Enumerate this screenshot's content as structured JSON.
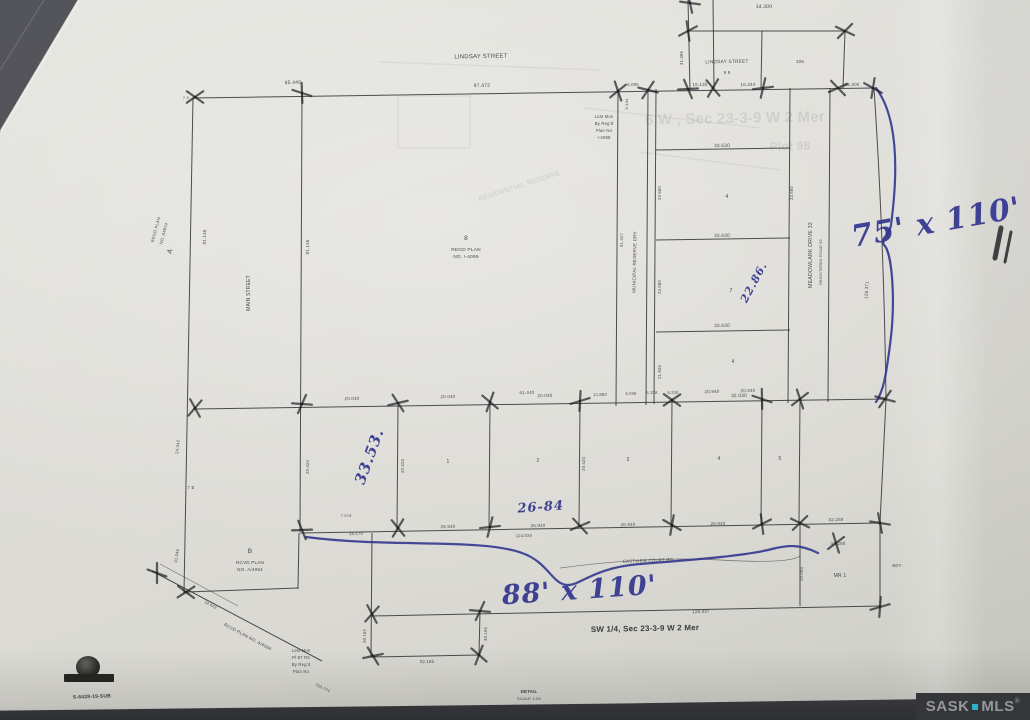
{
  "photo": {
    "paper_color": "#dddcd7",
    "background_color": "#515257",
    "ink_blue": "#32368f",
    "watermark": {
      "left": "SASK",
      "right": "MLS",
      "reg": "®",
      "dot_color": "#2fb0c6"
    }
  },
  "handwritten_annotations": {
    "right_lots": "75' x 110'",
    "bottom_lots": "88' x 110'",
    "depth_note": "33.53.",
    "width_note": "26-84",
    "lot7_note": "22.86."
  },
  "plan": {
    "title_quarter": "SW 1/4, Sec 23-3-9 W 2 Mer",
    "file_number": "S-6428-19-SUB",
    "labels": [
      {
        "t": "LINDSAY STREET",
        "x": 481,
        "y": 58,
        "r": -1,
        "s": 6,
        "n": "street-label-lindsay-west"
      },
      {
        "t": "97.472",
        "x": 482,
        "y": 87,
        "r": -1,
        "s": 5,
        "n": "dimension-label"
      },
      {
        "t": "85.440",
        "x": 293,
        "y": 84,
        "r": -2,
        "s": 5,
        "n": "dimension-label"
      },
      {
        "t": "7.9",
        "x": 186,
        "y": 99,
        "r": 0,
        "s": 4,
        "n": "dimension-label"
      },
      {
        "t": "34.300",
        "x": 764,
        "y": 8,
        "r": -1,
        "s": 5,
        "n": "dimension-label"
      },
      {
        "t": "LINDSAY STREET",
        "x": 727,
        "y": 63,
        "r": -1,
        "s": 4.8,
        "n": "street-label-lindsay-east"
      },
      {
        "t": "9 9",
        "x": 727,
        "y": 74,
        "r": 0,
        "s": 4.5,
        "n": "lot-number"
      },
      {
        "t": "105",
        "x": 800,
        "y": 63,
        "r": 0,
        "s": 4.5,
        "n": "lot-number"
      },
      {
        "t": "15.135",
        "x": 700,
        "y": 86,
        "r": -1,
        "s": 4.5,
        "n": "dimension-label"
      },
      {
        "t": "16.344",
        "x": 748,
        "y": 86,
        "r": -1,
        "s": 4.5,
        "n": "dimension-label"
      },
      {
        "t": "34.300",
        "x": 852,
        "y": 86,
        "r": -1,
        "s": 4.5,
        "n": "dimension-label"
      },
      {
        "t": "31.396",
        "x": 683,
        "y": 58,
        "r": -90,
        "s": 4.2,
        "n": "dimension-label"
      },
      {
        "t": "6.096",
        "x": 633,
        "y": 86,
        "r": -1,
        "s": 4.2,
        "n": "dimension-label"
      },
      {
        "t": "Lost Mon",
        "x": 604,
        "y": 118,
        "r": 0,
        "s": 4.2,
        "n": "monument-note"
      },
      {
        "t": "By Reg'd",
        "x": 604,
        "y": 125,
        "r": 0,
        "s": 4.2,
        "n": "monument-note"
      },
      {
        "t": "Plan No",
        "x": 604,
        "y": 132,
        "r": 0,
        "s": 4.2,
        "n": "monument-note"
      },
      {
        "t": "I-4099",
        "x": 604,
        "y": 139,
        "r": 0,
        "s": 4.2,
        "n": "monument-note"
      },
      {
        "t": "9.144",
        "x": 628,
        "y": 104,
        "r": -90,
        "s": 4,
        "n": "dimension-label"
      },
      {
        "t": "33.630",
        "x": 722,
        "y": 147,
        "r": -1,
        "s": 4.8,
        "n": "dimension-label"
      },
      {
        "t": "4",
        "x": 727,
        "y": 198,
        "r": 0,
        "s": 5,
        "n": "lot-number"
      },
      {
        "t": "33.630",
        "x": 722,
        "y": 237,
        "r": -1,
        "s": 4.8,
        "n": "dimension-label"
      },
      {
        "t": "7",
        "x": 731,
        "y": 292,
        "r": 0,
        "s": 5.5,
        "n": "lot-number"
      },
      {
        "t": "33.630",
        "x": 722,
        "y": 327,
        "r": -1,
        "s": 4.8,
        "n": "dimension-label"
      },
      {
        "t": "4",
        "x": 733,
        "y": 363,
        "r": 0,
        "s": 5,
        "n": "lot-number"
      },
      {
        "t": "32.030",
        "x": 739,
        "y": 397,
        "r": -1,
        "s": 4.8,
        "n": "dimension-label"
      },
      {
        "t": "23.680",
        "x": 661,
        "y": 193,
        "r": -90,
        "s": 4.2,
        "n": "dimension-label"
      },
      {
        "t": "23.680",
        "x": 661,
        "y": 287,
        "r": -90,
        "s": 4.2,
        "n": "dimension-label"
      },
      {
        "t": "23.680",
        "x": 793,
        "y": 193,
        "r": -90,
        "s": 4.2,
        "n": "dimension-label"
      },
      {
        "t": "21.945",
        "x": 661,
        "y": 372,
        "r": -90,
        "s": 4.2,
        "n": "dimension-label"
      },
      {
        "t": "MEADOWLARK DRIVE 32",
        "x": 812,
        "y": 255,
        "r": -90,
        "s": 5.2,
        "n": "street-label-meadowlark"
      },
      {
        "t": "REGISTERED ROAD 99",
        "x": 822,
        "y": 262,
        "r": -90,
        "s": 3.8,
        "n": "road-note"
      },
      {
        "t": "126.371",
        "x": 868,
        "y": 290,
        "r": -87,
        "s": 4.5,
        "n": "dimension-label"
      },
      {
        "t": "8",
        "x": 466,
        "y": 240,
        "r": 0,
        "s": 6.5,
        "n": "block-number"
      },
      {
        "t": "REGD PLAN",
        "x": 466,
        "y": 251,
        "r": 0,
        "s": 4.8,
        "n": "plan-note"
      },
      {
        "t": "NO. I-4099",
        "x": 466,
        "y": 258,
        "r": 0,
        "s": 4.8,
        "n": "plan-note"
      },
      {
        "t": "MAIN STREET",
        "x": 250,
        "y": 293,
        "r": -90,
        "s": 5,
        "n": "street-label-main"
      },
      {
        "t": "81.145",
        "x": 206,
        "y": 237,
        "r": -89,
        "s": 4.5,
        "n": "dimension-label"
      },
      {
        "t": "81.145",
        "x": 309,
        "y": 247,
        "r": -89,
        "s": 4.5,
        "n": "dimension-label"
      },
      {
        "t": "MUNICIPAL RESERVE DRY",
        "x": 636,
        "y": 262,
        "r": -89,
        "s": 4.5,
        "n": "reserve-label"
      },
      {
        "t": "91.427",
        "x": 623,
        "y": 240,
        "r": -89,
        "s": 4.2,
        "n": "dimension-label"
      },
      {
        "t": "A",
        "x": 172,
        "y": 252,
        "r": -70,
        "s": 7,
        "n": "parcel-label-a"
      },
      {
        "t": "REGD PLAN",
        "x": 157,
        "y": 230,
        "r": -75,
        "s": 4.2,
        "n": "plan-note"
      },
      {
        "t": "NO. A4874",
        "x": 165,
        "y": 234,
        "r": -75,
        "s": 4.2,
        "n": "plan-note"
      },
      {
        "t": "24.342",
        "x": 179,
        "y": 447,
        "r": -84,
        "s": 4.2,
        "n": "dimension-label"
      },
      {
        "t": "7 B",
        "x": 191,
        "y": 489,
        "r": 0,
        "s": 4.2,
        "n": "dimension-label"
      },
      {
        "t": "31.046",
        "x": 178,
        "y": 556,
        "r": -80,
        "s": 4.2,
        "n": "dimension-label"
      },
      {
        "t": "7.9",
        "x": 186,
        "y": 595,
        "r": 0,
        "s": 4,
        "n": "dimension-label"
      },
      {
        "t": "20.040",
        "x": 352,
        "y": 400,
        "r": -1,
        "s": 4.5,
        "n": "dimension-label"
      },
      {
        "t": "61.440",
        "x": 527,
        "y": 394,
        "r": -1,
        "s": 4.5,
        "n": "dimension-label"
      },
      {
        "t": "20.040",
        "x": 448,
        "y": 398,
        "r": -1,
        "s": 4.5,
        "n": "dimension-label"
      },
      {
        "t": "20.040",
        "x": 545,
        "y": 397,
        "r": -1,
        "s": 4.5,
        "n": "dimension-label"
      },
      {
        "t": "13.880",
        "x": 600,
        "y": 396,
        "r": -1,
        "s": 4.2,
        "n": "dimension-label"
      },
      {
        "t": "6.096",
        "x": 631,
        "y": 395,
        "r": -1,
        "s": 4,
        "n": "dimension-label"
      },
      {
        "t": "5.338",
        "x": 652,
        "y": 394,
        "r": -1,
        "s": 4,
        "n": "dimension-label"
      },
      {
        "t": "8.230",
        "x": 673,
        "y": 394,
        "r": -1,
        "s": 4,
        "n": "dimension-label"
      },
      {
        "t": "20.940",
        "x": 712,
        "y": 393,
        "r": -1,
        "s": 4.5,
        "n": "dimension-label"
      },
      {
        "t": "20.940",
        "x": 748,
        "y": 392,
        "r": -1,
        "s": 4.5,
        "n": "dimension-label"
      },
      {
        "t": "20.420",
        "x": 309,
        "y": 467,
        "r": -89,
        "s": 4.2,
        "n": "dimension-label"
      },
      {
        "t": "20.420",
        "x": 404,
        "y": 466,
        "r": -89,
        "s": 4.2,
        "n": "dimension-label"
      },
      {
        "t": "20.420",
        "x": 585,
        "y": 464,
        "r": -89,
        "s": 4.2,
        "n": "dimension-label"
      },
      {
        "t": "1",
        "x": 448,
        "y": 463,
        "r": 0,
        "s": 5,
        "n": "lot-number"
      },
      {
        "t": "2",
        "x": 538,
        "y": 462,
        "r": 0,
        "s": 5,
        "n": "lot-number"
      },
      {
        "t": "3",
        "x": 628,
        "y": 461,
        "r": 0,
        "s": 5,
        "n": "lot-number"
      },
      {
        "t": "4",
        "x": 719,
        "y": 460,
        "r": 0,
        "s": 5,
        "n": "lot-number"
      },
      {
        "t": "5",
        "x": 780,
        "y": 460,
        "r": 0,
        "s": 5,
        "n": "lot-number"
      },
      {
        "t": "7.975",
        "x": 346,
        "y": 517,
        "r": 0,
        "s": 4,
        "n": "dimension-label"
      },
      {
        "t": "14.170",
        "x": 356,
        "y": 535,
        "r": -1,
        "s": 4.2,
        "n": "dimension-label"
      },
      {
        "t": "26.940",
        "x": 448,
        "y": 528,
        "r": -1,
        "s": 4.5,
        "n": "dimension-label"
      },
      {
        "t": "26.940",
        "x": 538,
        "y": 527,
        "r": -1,
        "s": 4.5,
        "n": "dimension-label"
      },
      {
        "t": "114.035",
        "x": 524,
        "y": 537,
        "r": -1,
        "s": 4.2,
        "n": "dimension-label"
      },
      {
        "t": "26.940",
        "x": 628,
        "y": 526,
        "r": -1,
        "s": 4.5,
        "n": "dimension-label"
      },
      {
        "t": "26.940",
        "x": 718,
        "y": 525,
        "r": -1,
        "s": 4.5,
        "n": "dimension-label"
      },
      {
        "t": "32.288",
        "x": 836,
        "y": 521,
        "r": -1,
        "s": 4.5,
        "n": "dimension-label"
      },
      {
        "t": "32.288",
        "x": 838,
        "y": 545,
        "r": -1,
        "s": 4.5,
        "n": "dimension-label"
      },
      {
        "t": "20.068",
        "x": 803,
        "y": 574,
        "r": -89,
        "s": 4.2,
        "n": "dimension-label"
      },
      {
        "t": "MR 1",
        "x": 840,
        "y": 577,
        "r": 0,
        "s": 5,
        "n": "reserve-lot-label"
      },
      {
        "t": "BDY",
        "x": 897,
        "y": 567,
        "r": 0,
        "s": 4.2,
        "n": "boundary-note"
      },
      {
        "t": "EASTVIEW COURT RD",
        "x": 648,
        "y": 562,
        "r": -2,
        "s": 4.4,
        "n": "street-label-court"
      },
      {
        "t": "B",
        "x": 250,
        "y": 553,
        "r": 0,
        "s": 6.5,
        "n": "parcel-label-b"
      },
      {
        "t": "RCVD PLAN",
        "x": 250,
        "y": 564,
        "r": 0,
        "s": 4.6,
        "n": "plan-note"
      },
      {
        "t": "NO. A/4084",
        "x": 250,
        "y": 571,
        "r": 0,
        "s": 4.6,
        "n": "plan-note"
      },
      {
        "t": "RCVD PLAN NO. A/4084",
        "x": 247,
        "y": 638,
        "r": 28,
        "s": 4.4,
        "n": "road-plan-note"
      },
      {
        "t": "34.842",
        "x": 210,
        "y": 606,
        "r": 28,
        "s": 4,
        "n": "dimension-label"
      },
      {
        "t": "730.774",
        "x": 322,
        "y": 689,
        "r": 26,
        "s": 4,
        "n": "dimension-label"
      },
      {
        "t": "Lost Mon",
        "x": 301,
        "y": 652,
        "r": 0,
        "s": 4.2,
        "n": "monument-note"
      },
      {
        "t": "Pl 97 R2",
        "x": 301,
        "y": 659,
        "r": 0,
        "s": 4.2,
        "n": "monument-note"
      },
      {
        "t": "By Reg'd",
        "x": 301,
        "y": 666,
        "r": 0,
        "s": 4.2,
        "n": "monument-note"
      },
      {
        "t": "Plan No",
        "x": 301,
        "y": 673,
        "r": 0,
        "s": 4.2,
        "n": "monument-note"
      },
      {
        "t": "30.165",
        "x": 366,
        "y": 636,
        "r": -89,
        "s": 4.2,
        "n": "dimension-label"
      },
      {
        "t": "30.165",
        "x": 487,
        "y": 634,
        "r": -89,
        "s": 4.2,
        "n": "dimension-label"
      },
      {
        "t": "32.185",
        "x": 427,
        "y": 663,
        "r": -1,
        "s": 4.4,
        "n": "dimension-label"
      },
      {
        "t": "SW 1/4, Sec 23-3-9 W 2 Mer",
        "x": 645,
        "y": 631,
        "r": -1,
        "s": 8,
        "k": "bold",
        "n": "quarter-section-title"
      },
      {
        "t": "128.037",
        "x": 701,
        "y": 613,
        "r": -1,
        "s": 4.4,
        "n": "dimension-label"
      },
      {
        "t": "S-6428-19-SUB",
        "x": 92,
        "y": 698,
        "r": -2,
        "s": 5,
        "k": "bold",
        "n": "file-number-label"
      },
      {
        "t": "DETAIL",
        "x": 529,
        "y": 693,
        "r": 0,
        "s": 4.4,
        "k": "bold",
        "n": "detail-label"
      },
      {
        "t": "SCALE 1:50",
        "x": 529,
        "y": 700,
        "r": 0,
        "s": 4,
        "n": "scale-label"
      },
      {
        "t": "6 W , Sec 23-3-9 W 2 Mer",
        "x": 735,
        "y": 123,
        "r": -1,
        "s": 15,
        "k": "ghost",
        "n": "bleedthrough-text"
      },
      {
        "t": "Plot 98",
        "x": 790,
        "y": 150,
        "r": -1,
        "s": 12,
        "k": "ghost",
        "n": "bleedthrough-text"
      },
      {
        "t": "RESIDENTIAL RESERVE",
        "x": 520,
        "y": 188,
        "r": -18,
        "s": 7,
        "k": "ghost",
        "n": "bleedthrough-text"
      },
      {
        "t": "75' x 110'",
        "x": 938,
        "y": 232,
        "r": -10,
        "s": 30,
        "k": "blue",
        "n": "annotation-75x110"
      },
      {
        "t": "88' x 110'",
        "x": 580,
        "y": 599,
        "r": -4,
        "s": 27,
        "k": "blue",
        "n": "annotation-88x110"
      },
      {
        "t": "33.53.",
        "x": 374,
        "y": 458,
        "r": -70,
        "s": 15,
        "k": "blue",
        "n": "annotation-3353"
      },
      {
        "t": "26-84",
        "x": 541,
        "y": 511,
        "r": -4,
        "s": 13,
        "k": "blue",
        "n": "annotation-2684"
      },
      {
        "t": "22.86.",
        "x": 757,
        "y": 284,
        "r": -62,
        "s": 11,
        "k": "blue",
        "n": "annotation-2286"
      }
    ]
  }
}
